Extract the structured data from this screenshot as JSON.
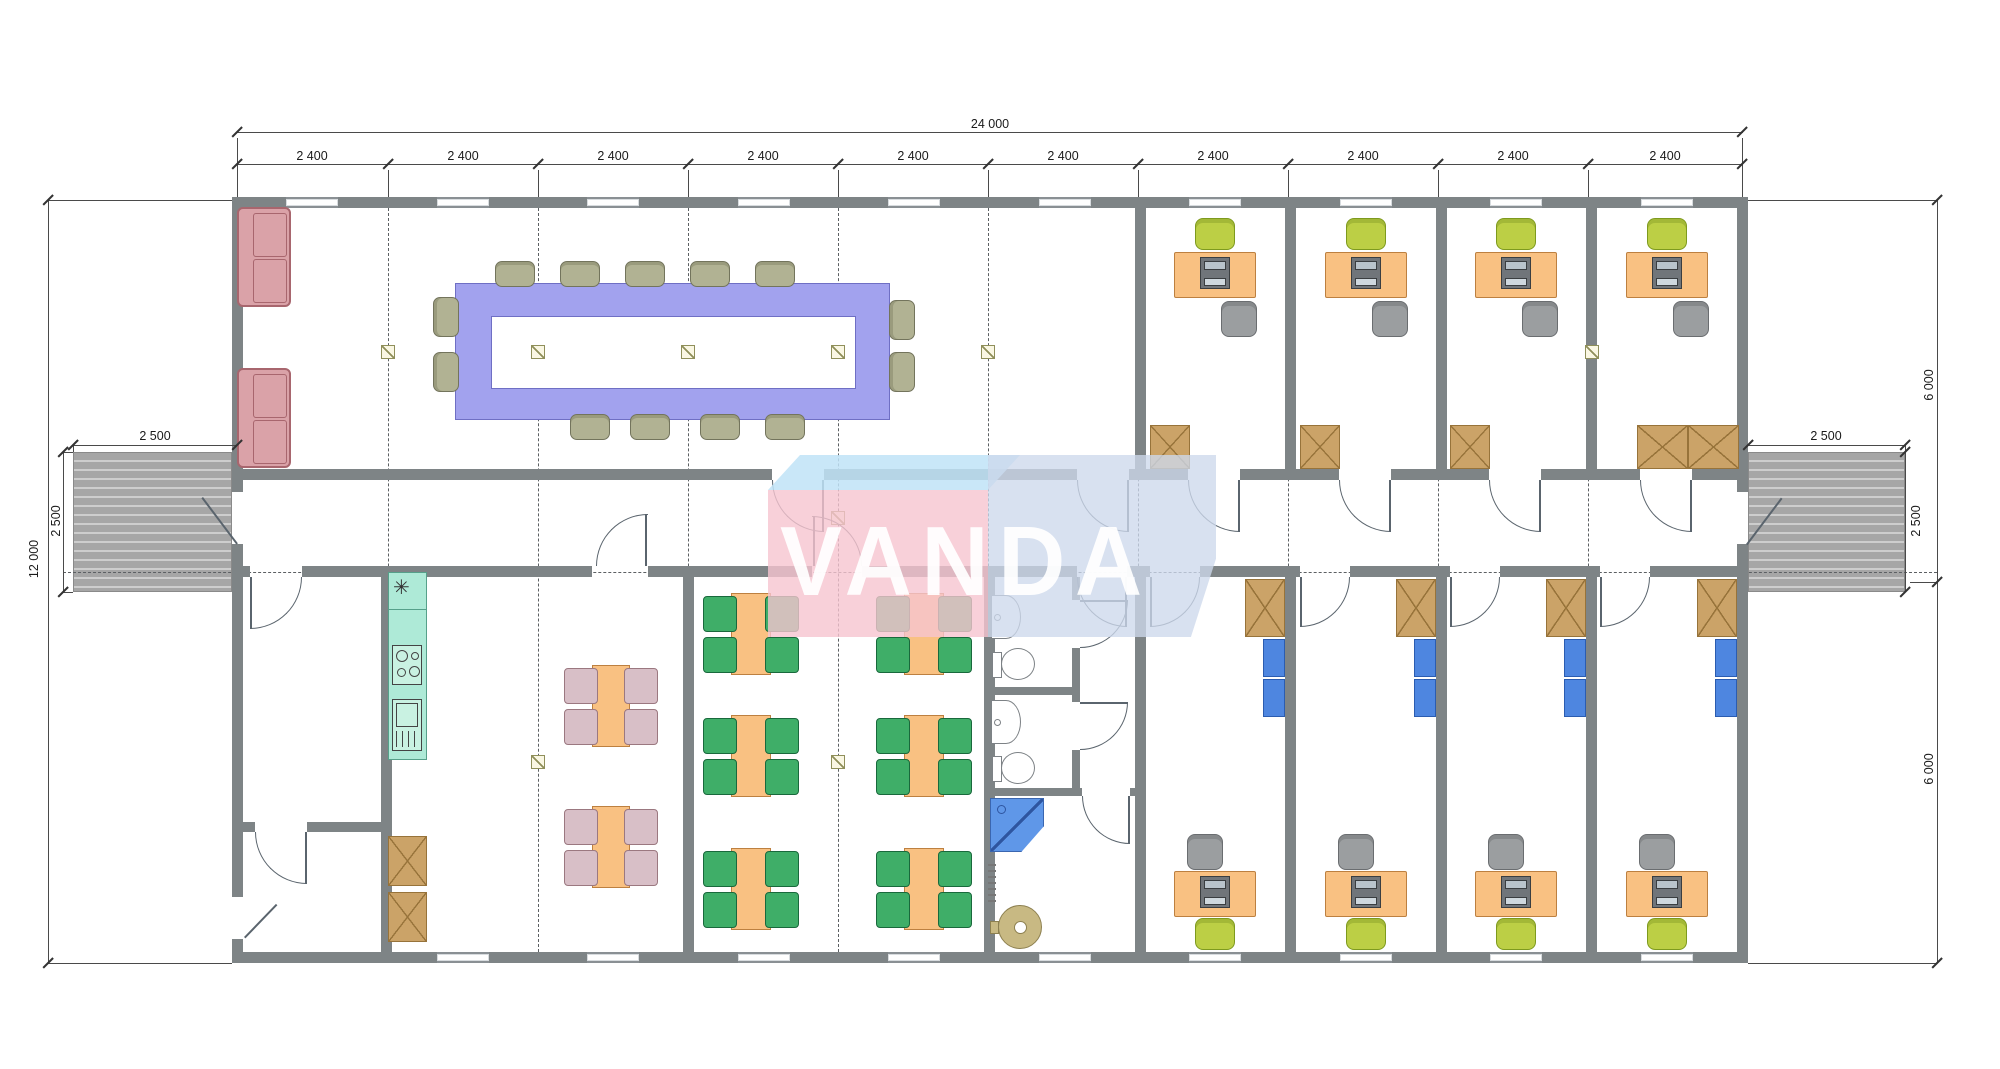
{
  "watermark": {
    "text": "VANDA"
  },
  "dims": {
    "total_width": "24 000",
    "bay": "2 400",
    "total_height": "12 000",
    "porch_width": "2 500",
    "porch_depth": "2 500",
    "half_height_top": "6 000",
    "half_height_bottom": "6 000"
  },
  "kitchen": {
    "sink_symbol": "✳"
  },
  "colors": {
    "wall": "#7e8486",
    "conference_table": "#a2a2ee",
    "desk": "#f9c182",
    "chair_lime": "#bccf45",
    "chair_gray": "#9b9ea0",
    "chair_conference": "#b1b293",
    "chair_green": "#3fae68",
    "chair_pink": "#d8bfc7",
    "sofa": "#daa2a8",
    "cabinet": "#cba368",
    "shelf_blue": "#4e86e0",
    "kitchen_counter": "#aeead7",
    "shower": "#5f97e8",
    "logo_pink": "#f6c4d0",
    "logo_blue": "#bfe3f7",
    "logo_panel": "#ccd9ec"
  }
}
